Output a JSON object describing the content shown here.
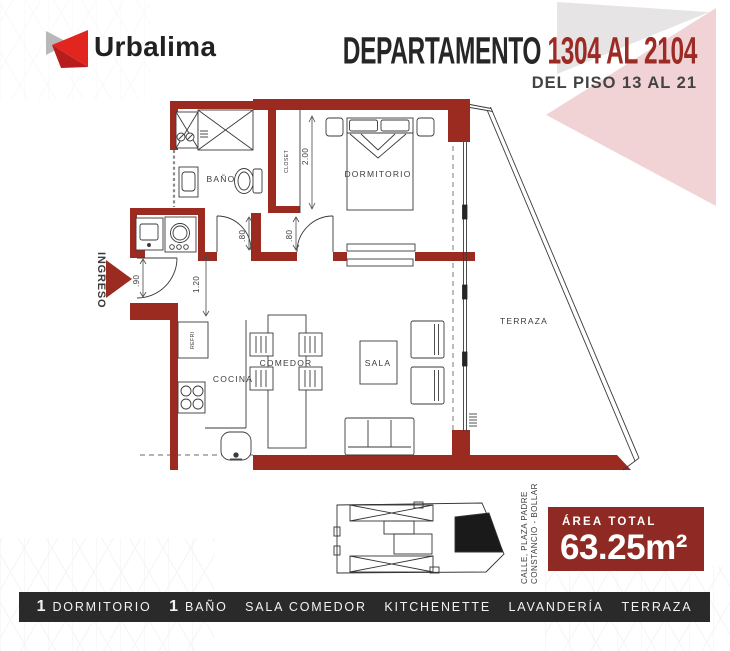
{
  "header": {
    "brand": "Urbalima",
    "title_main": "DEPARTAMENTO",
    "title_accent": "1304 AL 2104",
    "subtitle": "DEL PISO 13 AL 21"
  },
  "plan": {
    "labels": {
      "ingreso": "INGRESO",
      "banio": "BAÑO",
      "closet": "CLOSET",
      "dormitorio": "DORMITORIO",
      "refri": "REFRI",
      "cocina": "COCINA",
      "comedor": "COMEDOR",
      "sala": "SALA",
      "terraza": "TERRAZA"
    },
    "dimensions": {
      "closet_depth": "2.00",
      "bath_door": ".80",
      "bedroom_door": ".80",
      "entry_door": ".90",
      "hall_width": "1.20"
    }
  },
  "keyplan": {
    "street_line1": "CALLE, PLAZA PADRE",
    "street_line2": "CONSTANCIO - BOLLAR"
  },
  "area_badge": {
    "label": "ÁREA TOTAL",
    "value": "63.25m²"
  },
  "footer": {
    "items": [
      {
        "count": "1",
        "label": "DORMITORIO"
      },
      {
        "count": "1",
        "label": "BAÑO"
      },
      {
        "count": "",
        "label": "SALA COMEDOR"
      },
      {
        "count": "",
        "label": "KITCHENETTE"
      },
      {
        "count": "",
        "label": "LAVANDERÍA"
      },
      {
        "count": "",
        "label": "TERRAZA"
      }
    ]
  },
  "colors": {
    "wall": "#9b2b21",
    "accent_red": "#9c2b26",
    "logo_red": "#e2251f",
    "logo_red_dark": "#b71d1c",
    "logo_gray": "#b9b7b8",
    "badge_red": "#8e2a23",
    "footer_bar": "#2b2a2a",
    "pink": "#f1d3d6",
    "gray_triangle": "#e6e4e5"
  }
}
